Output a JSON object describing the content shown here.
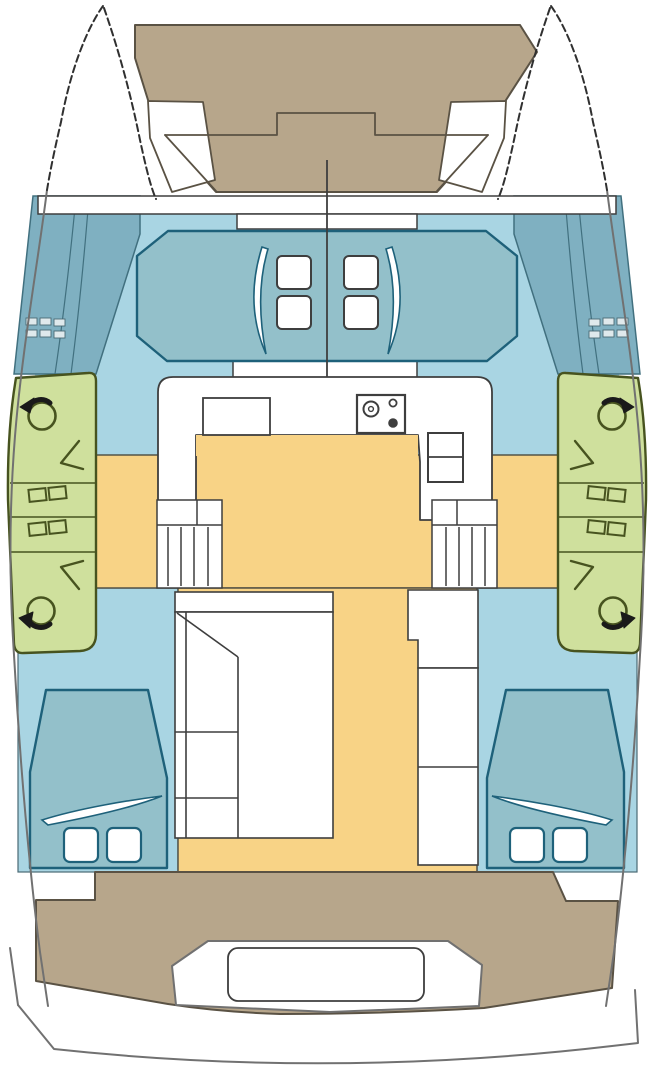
{
  "title": "catamaran-deck-plan",
  "colors": {
    "background": "#ffffff",
    "white": "#ffffff",
    "deck_tan": "#b7a68b",
    "deck_line": "#5a5244",
    "cabin_blue": "#a9d5e3",
    "hull_band_teal": "#7fb0c1",
    "band_line": "#41707f",
    "berth_teal": "#93c0ca",
    "berth_line": "#1e617a",
    "panel_green": "#cfe09d",
    "panel_line": "#47531f",
    "floor_yellow": "#f8d386",
    "floor_line": "#4a4a40",
    "dark_line": "#3e3e3e",
    "hull_gray": "#717171",
    "bow_dash": "#303030",
    "black": "#1a1a1a",
    "step_fill": "#dfe9ec",
    "step_line": "#4a6a74"
  },
  "icons": {
    "winch": "winch-drum-rotation-arrow-icon",
    "rope_clutch": "rope-clutch-pair-icon",
    "line_lead": "line-lead-arrow-icon",
    "stove": "four-burner-stove-icon",
    "sink": "double-sink-icon",
    "berth": "double-berth-with-pillows-icon",
    "stairs": "companionway-steps-icon"
  }
}
